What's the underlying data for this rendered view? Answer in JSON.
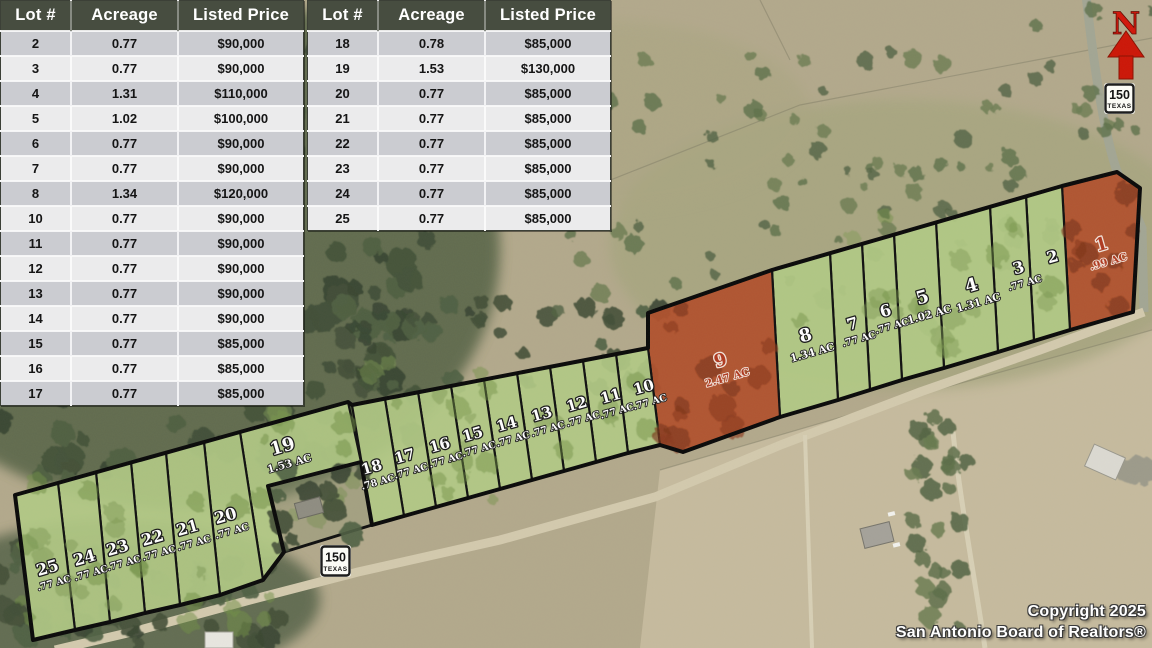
{
  "tables": [
    {
      "headers": [
        "Lot #",
        "Acreage",
        "Listed Price"
      ],
      "rows": [
        [
          "2",
          "0.77",
          "$90,000"
        ],
        [
          "3",
          "0.77",
          "$90,000"
        ],
        [
          "4",
          "1.31",
          "$110,000"
        ],
        [
          "5",
          "1.02",
          "$100,000"
        ],
        [
          "6",
          "0.77",
          "$90,000"
        ],
        [
          "7",
          "0.77",
          "$90,000"
        ],
        [
          "8",
          "1.34",
          "$120,000"
        ],
        [
          "10",
          "0.77",
          "$90,000"
        ],
        [
          "11",
          "0.77",
          "$90,000"
        ],
        [
          "12",
          "0.77",
          "$90,000"
        ],
        [
          "13",
          "0.77",
          "$90,000"
        ],
        [
          "14",
          "0.77",
          "$90,000"
        ],
        [
          "15",
          "0.77",
          "$85,000"
        ],
        [
          "16",
          "0.77",
          "$85,000"
        ],
        [
          "17",
          "0.77",
          "$85,000"
        ]
      ]
    },
    {
      "headers": [
        "Lot #",
        "Acreage",
        "Listed Price"
      ],
      "rows": [
        [
          "18",
          "0.78",
          "$85,000"
        ],
        [
          "19",
          "1.53",
          "$130,000"
        ],
        [
          "20",
          "0.77",
          "$85,000"
        ],
        [
          "21",
          "0.77",
          "$85,000"
        ],
        [
          "22",
          "0.77",
          "$85,000"
        ],
        [
          "23",
          "0.77",
          "$85,000"
        ],
        [
          "24",
          "0.77",
          "$85,000"
        ],
        [
          "25",
          "0.77",
          "$85,000"
        ]
      ]
    }
  ],
  "map": {
    "north_label": "N",
    "shield": {
      "number": "150",
      "state": "TEXAS"
    },
    "colors": {
      "available": "#b2ca85",
      "unavailable": "#b1512d",
      "label_available": "#ffffff",
      "label_unavailable": "#b03a20"
    },
    "lots": [
      {
        "number": "1",
        "acreage_label": ".99 AC",
        "status": "unavailable"
      },
      {
        "number": "2",
        "acreage_label": "",
        "status": "available"
      },
      {
        "number": "3",
        "acreage_label": ".77 AC",
        "status": "available"
      },
      {
        "number": "4",
        "acreage_label": "1.31 AC",
        "status": "available"
      },
      {
        "number": "5",
        "acreage_label": "1.02 AC",
        "status": "available"
      },
      {
        "number": "6",
        "acreage_label": ".77 AC",
        "status": "available"
      },
      {
        "number": "7",
        "acreage_label": ".77 AC",
        "status": "available"
      },
      {
        "number": "8",
        "acreage_label": "1.34 AC",
        "status": "available"
      },
      {
        "number": "9",
        "acreage_label": "2.47 AC",
        "status": "unavailable"
      },
      {
        "number": "10",
        "acreage_label": ".77 AC",
        "status": "available"
      },
      {
        "number": "11",
        "acreage_label": ".77 AC",
        "status": "available"
      },
      {
        "number": "12",
        "acreage_label": ".77 AC",
        "status": "available"
      },
      {
        "number": "13",
        "acreage_label": ".77 AC",
        "status": "available"
      },
      {
        "number": "14",
        "acreage_label": ".77 AC",
        "status": "available"
      },
      {
        "number": "15",
        "acreage_label": ".77 AC",
        "status": "available"
      },
      {
        "number": "16",
        "acreage_label": ".77 AC",
        "status": "available"
      },
      {
        "number": "17",
        "acreage_label": ".77 AC",
        "status": "available"
      },
      {
        "number": "18",
        "acreage_label": ".78 AC",
        "status": "available"
      },
      {
        "number": "19",
        "acreage_label": "1.53 AC",
        "status": "available"
      },
      {
        "number": "20",
        "acreage_label": ".77 AC",
        "status": "available"
      },
      {
        "number": "21",
        "acreage_label": ".77 AC",
        "status": "available"
      },
      {
        "number": "22",
        "acreage_label": ".77 AC",
        "status": "available"
      },
      {
        "number": "23",
        "acreage_label": ".77 AC",
        "status": "available"
      },
      {
        "number": "24",
        "acreage_label": ".77 AC",
        "status": "available"
      },
      {
        "number": "25",
        "acreage_label": ".77 AC",
        "status": "available"
      }
    ]
  },
  "copyright": {
    "line1": "Copyright 2025",
    "line2": "San Antonio Board of Realtors®"
  }
}
